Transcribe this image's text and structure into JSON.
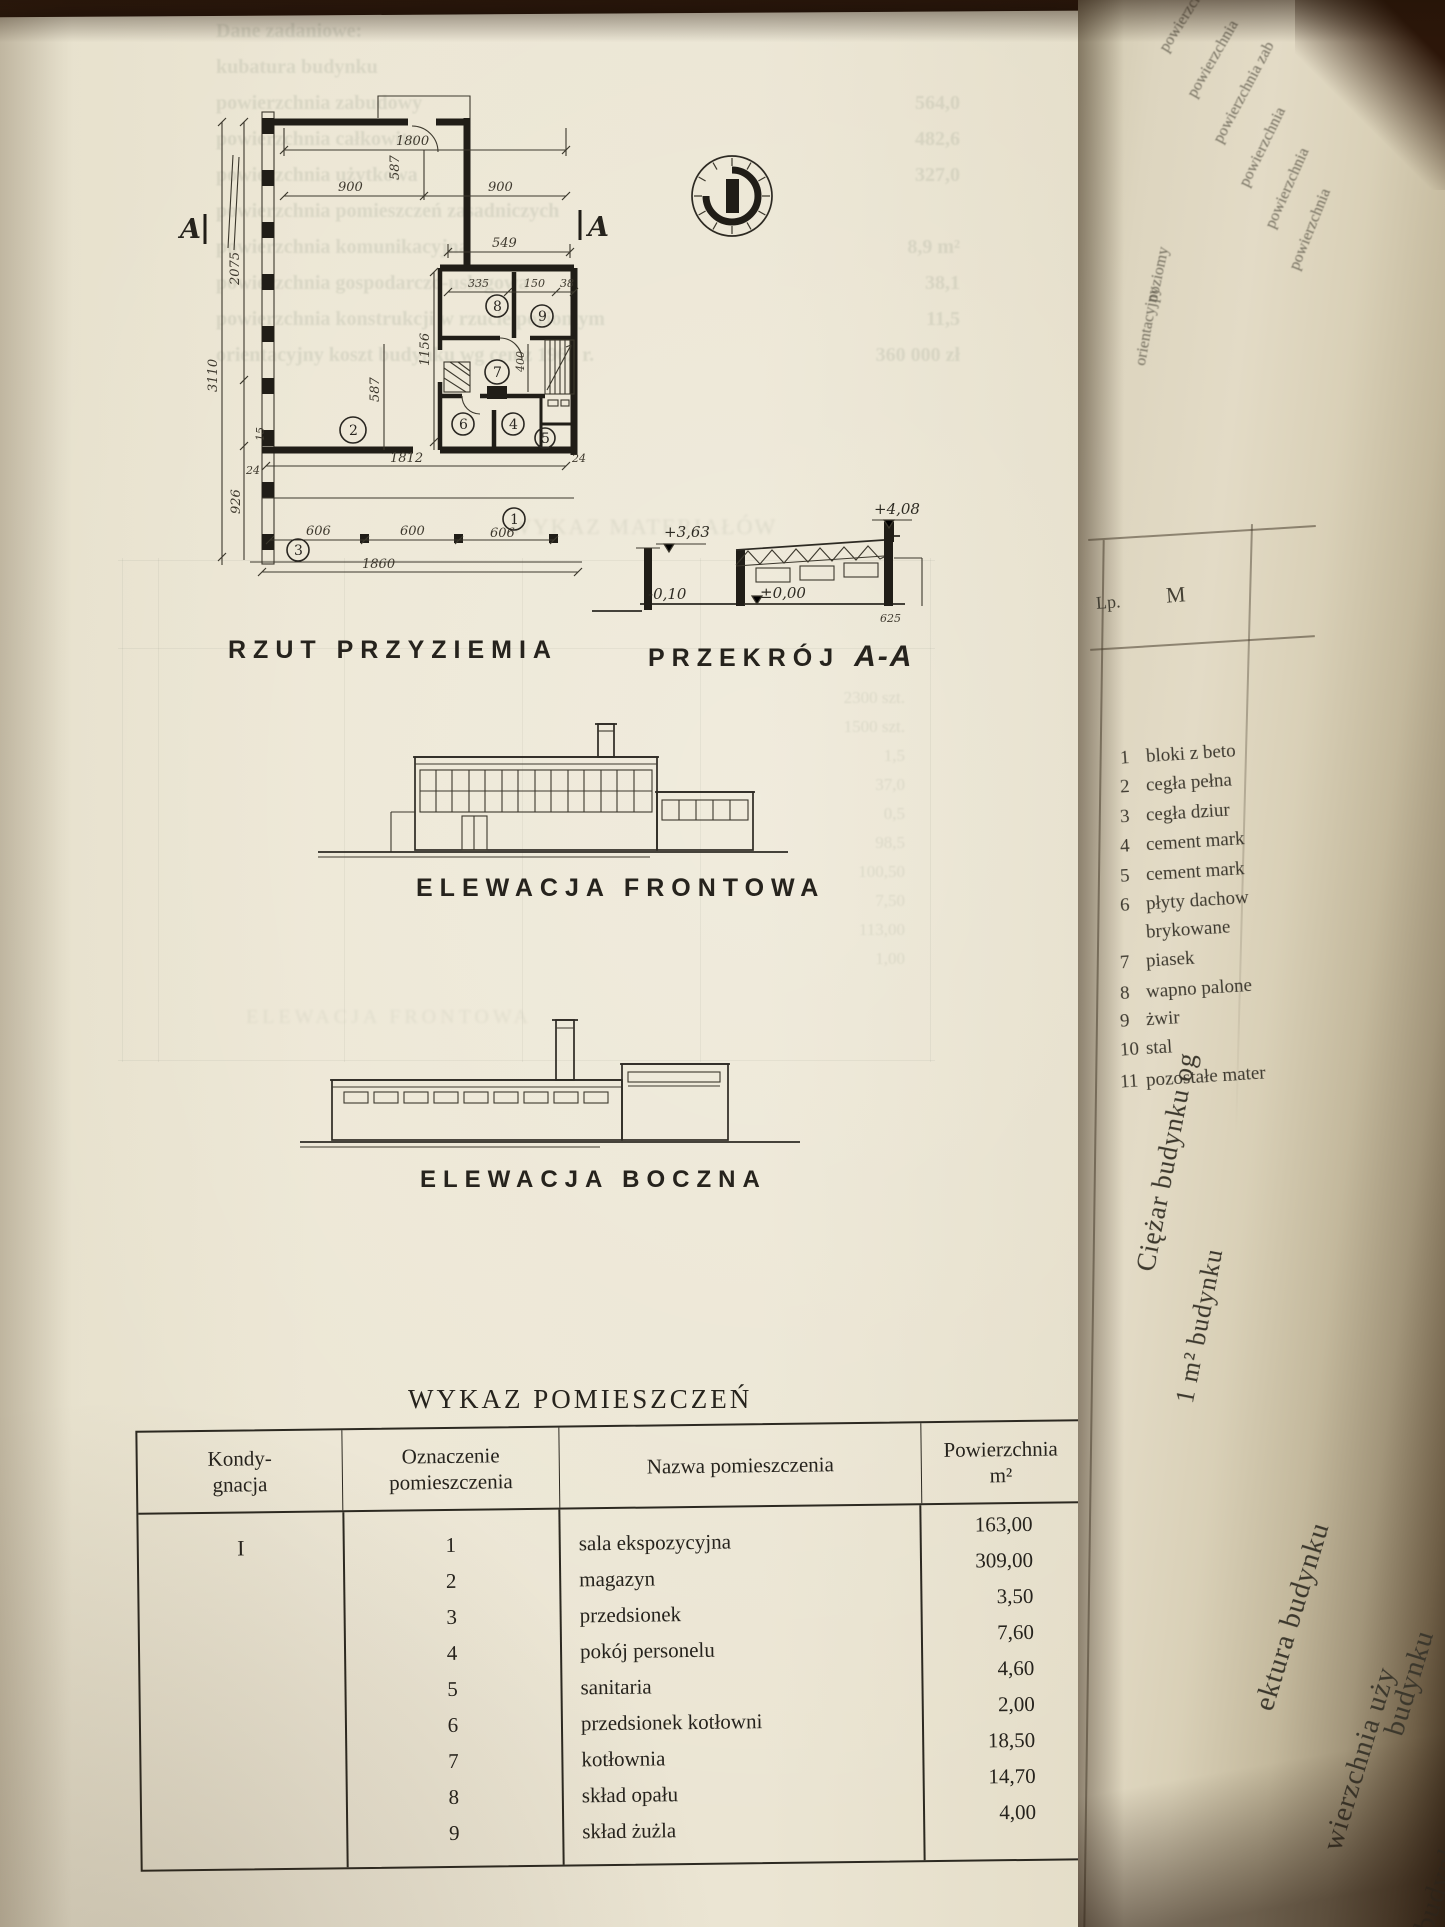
{
  "photo": {
    "paper_color": "#ebe5d3",
    "ink_color": "#26231d",
    "background_color": "#38200f"
  },
  "plan": {
    "title": "RZUT PRZYZIEMIA",
    "section_marker": "A",
    "dims": {
      "w1800": "1800",
      "w900a": "900",
      "w900b": "900",
      "h587a": "587",
      "h587b": "587",
      "w549": "549",
      "w335": "335",
      "w150": "150",
      "w38": "38",
      "h400": "400",
      "h1156": "1156",
      "h2075": "2075",
      "h3110": "3110",
      "h926": "926",
      "s15": "15",
      "s24a": "24",
      "s24b": "24",
      "w1812": "1812",
      "w606a": "606",
      "w600": "600",
      "w606b": "606",
      "w1860": "1860"
    },
    "rooms": {
      "r1": "1",
      "r2": "2",
      "r3": "3",
      "r4": "4",
      "r5": "5",
      "r6": "6",
      "r7": "7",
      "r8": "8",
      "r9": "9"
    }
  },
  "section": {
    "title_a": "PRZEKRÓJ",
    "title_b": "A-A",
    "lv_peak": "+4,08",
    "lv_eaves": "+3,63",
    "lv_zero": "±0,00",
    "lv_minus": "-0,10",
    "d625": "625"
  },
  "front": {
    "title": "ELEWACJA FRONTOWA"
  },
  "side": {
    "title": "ELEWACJA BOCZNA"
  },
  "room_table": {
    "heading": "WYKAZ POMIESZCZEŃ",
    "col1a": "Kondy-",
    "col1b": "gnacja",
    "col2a": "Oznaczenie",
    "col2b": "pomieszczenia",
    "col3": "Nazwa pomieszczenia",
    "col4a": "Powierzchnia",
    "col4b": "m²",
    "storey": "I",
    "rows": [
      {
        "no": "1",
        "name": "sala ekspozycyjna",
        "area": "163,00"
      },
      {
        "no": "2",
        "name": "magazyn",
        "area": "309,00"
      },
      {
        "no": "3",
        "name": "przedsionek",
        "area": "3,50"
      },
      {
        "no": "4",
        "name": "pokój personelu",
        "area": "7,60"
      },
      {
        "no": "5",
        "name": "sanitaria",
        "area": "4,60"
      },
      {
        "no": "6",
        "name": "przedsionek kotłowni",
        "area": "2,00"
      },
      {
        "no": "7",
        "name": "kotłownia",
        "area": "18,50"
      },
      {
        "no": "8",
        "name": "skład opału",
        "area": "14,70"
      },
      {
        "no": "9",
        "name": "skład żużla",
        "area": "4,00"
      }
    ]
  },
  "bleedthrough": {
    "lines": [
      {
        "text": "Dane zadaniowe:",
        "value": ""
      },
      {
        "text": "kubatura budynku",
        "value": ""
      },
      {
        "text": "powierzchnia zabudowy",
        "value": "564,0"
      },
      {
        "text": "powierzchnia całkowita",
        "value": "482,6"
      },
      {
        "text": "powierzchnia użytkowa",
        "value": "327,0"
      },
      {
        "text": "powierzchnia pomieszczeń zasadniczych",
        "value": ""
      },
      {
        "text": "powierzchnia komunikacyjna",
        "value": "8,9 m²"
      },
      {
        "text": "powierzchnia gospodarczo-usługowa",
        "value": "38,1"
      },
      {
        "text": "powierzchnia konstrukcji w rzucie poziomym",
        "value": "11,5"
      },
      {
        "text": "orientacyjny koszt budynku wg cen z 1962 r.",
        "value": "360 000 zł"
      }
    ],
    "ghost_title": "WYKAZ MATERIAŁÓW",
    "ghost_elev": "ELEWACJA FRONTOWA",
    "ghost_values": [
      "2300 szt.",
      "1500 szt.",
      "1,5",
      "37,0",
      "0,5",
      "98,5",
      "100,50",
      "7,50",
      "113,00",
      "1,00"
    ]
  },
  "next_page": {
    "header_lp": "Lp.",
    "header_m": "M",
    "top_lines": [
      "powierzchnia",
      "powierzchnia",
      "powierzchnia zab",
      "powierzchnia",
      "powierzchnia",
      "powierzchnia",
      "poziomy",
      "orientacyjny"
    ],
    "items": [
      {
        "no": "1",
        "text": "bloki z beto"
      },
      {
        "no": "2",
        "text": "cegła pełna"
      },
      {
        "no": "3",
        "text": "cegła dziur"
      },
      {
        "no": "4",
        "text": "cement mark"
      },
      {
        "no": "5",
        "text": "cement mark"
      },
      {
        "no": "6",
        "text": "płyty dachow"
      },
      {
        "no": "",
        "text": "brykowane"
      },
      {
        "no": "7",
        "text": "piasek"
      },
      {
        "no": "8",
        "text": "wapno palone"
      },
      {
        "no": "9",
        "text": "żwir"
      },
      {
        "no": "10",
        "text": "stal"
      },
      {
        "no": "11",
        "text": "pozostałe mater"
      }
    ],
    "edge_lines": [
      "Ciężar budynku og",
      "1 m² budynku",
      "ektura budynku",
      "wierzchnia uży",
      "budynku",
      "budynku uży"
    ]
  }
}
